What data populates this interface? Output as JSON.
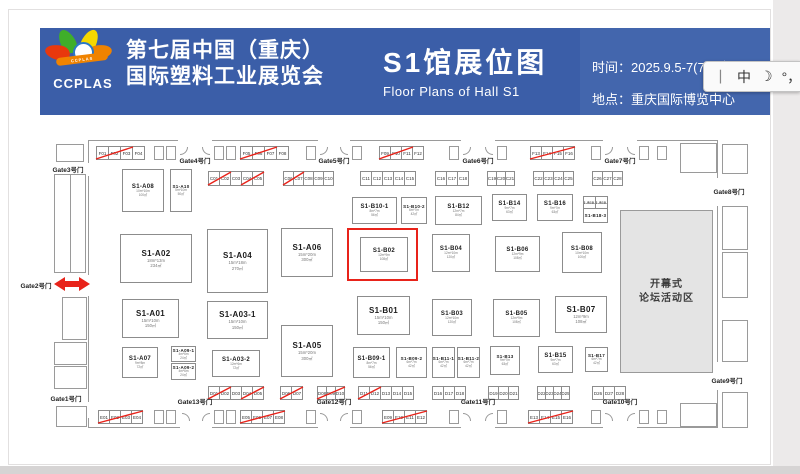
{
  "header": {
    "logo_text": "CCPLAS",
    "logo_ribbon_text": "CCPLAS",
    "title_cn_line1": "第七届中国（重庆）",
    "title_cn_line2": "国际塑料工业展览会",
    "hall_title_cn": "S1馆展位图",
    "hall_title_en": "Floor Plans of Hall S1",
    "time_label": "时间：",
    "time_value": "2025.9.5-7(7.11拟)",
    "venue_label": "地点：",
    "venue_value": "重庆国际博览中心",
    "bg_color": "#3b5ea8"
  },
  "ime_bar": {
    "items": [
      "丨",
      "中",
      "☽",
      "°，",
      "8"
    ]
  },
  "floorplan": {
    "wall_color": "#9a9a9a",
    "accent_red": "#e8231a",
    "hall": {
      "x": 88,
      "y": 140,
      "w": 630,
      "h": 288
    },
    "forum_area": {
      "line1": "开幕式",
      "line2": "论坛活动区",
      "x": 620,
      "y": 210,
      "w": 93,
      "h": 163
    },
    "highlight_box": {
      "x": 347,
      "y": 228,
      "w": 71,
      "h": 53
    },
    "booths": [
      {
        "id": "S1-A08",
        "dims": "10m*10m",
        "area": "100㎡",
        "x": 122,
        "y": 169,
        "w": 42,
        "h": 43
      },
      {
        "id": "S1-A10",
        "dims": "5m*10m",
        "area": "50㎡",
        "x": 170,
        "y": 169,
        "w": 22,
        "h": 43
      },
      {
        "id": "S1-B10-1",
        "dims": "8m*7m",
        "area": "56㎡",
        "x": 352,
        "y": 197,
        "w": 45,
        "h": 27
      },
      {
        "id": "S1-B10-2",
        "dims": "6m*7m",
        "area": "42㎡",
        "x": 401,
        "y": 197,
        "w": 26,
        "h": 27
      },
      {
        "id": "S1-B12",
        "dims": "12m*7m",
        "area": "84㎡",
        "x": 435,
        "y": 196,
        "w": 47,
        "h": 29
      },
      {
        "id": "S1-B14",
        "dims": "9m*7m",
        "area": "63㎡",
        "x": 492,
        "y": 194,
        "w": 35,
        "h": 27
      },
      {
        "id": "S1-B16",
        "dims": "9m*7m",
        "area": "63㎡",
        "x": 537,
        "y": 194,
        "w": 36,
        "h": 27
      },
      {
        "id": "S1-B18-1",
        "dims": "",
        "area": "",
        "x": 583,
        "y": 196,
        "w": 13,
        "h": 13
      },
      {
        "id": "S1-B18-2",
        "dims": "",
        "area": "",
        "x": 595,
        "y": 196,
        "w": 13,
        "h": 13
      },
      {
        "id": "S1-B18-3",
        "dims": "",
        "area": "",
        "x": 583,
        "y": 208,
        "w": 25,
        "h": 15
      },
      {
        "id": "S1-A02",
        "dims": "18m*13m",
        "area": "234㎡",
        "x": 120,
        "y": 234,
        "w": 72,
        "h": 49
      },
      {
        "id": "S1-A04",
        "dims": "15m*18m",
        "area": "270㎡",
        "x": 207,
        "y": 229,
        "w": 61,
        "h": 64
      },
      {
        "id": "S1-A06",
        "dims": "15m*20m",
        "area": "300㎡",
        "x": 281,
        "y": 228,
        "w": 52,
        "h": 49
      },
      {
        "id": "S1-B02",
        "dims": "12m*9m",
        "area": "108㎡",
        "x": 360,
        "y": 237,
        "w": 48,
        "h": 35,
        "highlighted": true
      },
      {
        "id": "S1-B04",
        "dims": "12m*10m",
        "area": "120㎡",
        "x": 432,
        "y": 234,
        "w": 38,
        "h": 38
      },
      {
        "id": "S1-B06",
        "dims": "12m*9m",
        "area": "108㎡",
        "x": 495,
        "y": 236,
        "w": 45,
        "h": 36
      },
      {
        "id": "S1-B08",
        "dims": "10m*10m",
        "area": "100㎡",
        "x": 562,
        "y": 232,
        "w": 40,
        "h": 41
      },
      {
        "id": "S1-A01",
        "dims": "15m*10m",
        "area": "150㎡",
        "x": 122,
        "y": 299,
        "w": 57,
        "h": 39
      },
      {
        "id": "S1-A03-1",
        "dims": "15m*10m",
        "area": "150㎡",
        "x": 207,
        "y": 301,
        "w": 61,
        "h": 38
      },
      {
        "id": "S1-B01",
        "dims": "15m*10m",
        "area": "150㎡",
        "x": 357,
        "y": 296,
        "w": 53,
        "h": 39
      },
      {
        "id": "S1-B03",
        "dims": "12m*10m",
        "area": "120㎡",
        "x": 432,
        "y": 299,
        "w": 40,
        "h": 37
      },
      {
        "id": "S1-B05",
        "dims": "12m*9m",
        "area": "108㎡",
        "x": 493,
        "y": 299,
        "w": 47,
        "h": 38
      },
      {
        "id": "S1-B07",
        "dims": "12m*9m",
        "area": "108㎡",
        "x": 555,
        "y": 296,
        "w": 52,
        "h": 37
      },
      {
        "id": "S1-A07",
        "dims": "9m*8m",
        "area": "72㎡",
        "x": 122,
        "y": 347,
        "w": 36,
        "h": 31
      },
      {
        "id": "S1-A09-1",
        "dims": "4m*6m",
        "area": "24㎡",
        "x": 171,
        "y": 346,
        "w": 25,
        "h": 16
      },
      {
        "id": "S1-A09-2",
        "dims": "4m*6m",
        "area": "24㎡",
        "x": 171,
        "y": 363,
        "w": 25,
        "h": 17
      },
      {
        "id": "S1-A03-2",
        "dims": "12m*6m",
        "area": "72㎡",
        "x": 212,
        "y": 350,
        "w": 48,
        "h": 27
      },
      {
        "id": "S1-A05",
        "dims": "15m*20m",
        "area": "300㎡",
        "x": 281,
        "y": 325,
        "w": 52,
        "h": 52
      },
      {
        "id": "S1-B09-1",
        "dims": "8m*7m",
        "area": "56㎡",
        "x": 353,
        "y": 347,
        "w": 37,
        "h": 31
      },
      {
        "id": "S1-B09-2",
        "dims": "6m*7m",
        "area": "42㎡",
        "x": 396,
        "y": 347,
        "w": 31,
        "h": 31
      },
      {
        "id": "S1-B11-1",
        "dims": "6m*7m",
        "area": "42㎡",
        "x": 432,
        "y": 347,
        "w": 23,
        "h": 31
      },
      {
        "id": "S1-B11-2",
        "dims": "6m*7m",
        "area": "42㎡",
        "x": 457,
        "y": 347,
        "w": 23,
        "h": 31
      },
      {
        "id": "S1-B13",
        "dims": "9m*7m",
        "area": "63㎡",
        "x": 490,
        "y": 346,
        "w": 30,
        "h": 29
      },
      {
        "id": "S1-B15",
        "dims": "9m*7m",
        "area": "63㎡",
        "x": 538,
        "y": 346,
        "w": 35,
        "h": 27
      },
      {
        "id": "S1-B17",
        "dims": "6m*7m",
        "area": "42㎡",
        "x": 585,
        "y": 347,
        "w": 23,
        "h": 25
      }
    ],
    "cell_groups": [
      {
        "cells": [
          "F01",
          "F02",
          "F03",
          "F04"
        ],
        "x": 96,
        "y": 146,
        "cw": 13,
        "ch": 14,
        "strikes": [
          [
            0,
            2
          ]
        ]
      },
      {
        "cells": [
          "F05",
          "F06",
          "F07",
          "F08"
        ],
        "x": 240,
        "y": 146,
        "cw": 13,
        "ch": 14,
        "strikes": [
          [
            0,
            2
          ]
        ]
      },
      {
        "cells": [
          "F09",
          "F10",
          "F11",
          "F12"
        ],
        "x": 379,
        "y": 146,
        "cw": 12,
        "ch": 14,
        "strikes": [
          [
            0,
            2
          ]
        ]
      },
      {
        "cells": [
          "F13",
          "F14",
          "F15",
          "F16"
        ],
        "x": 530,
        "y": 146,
        "cw": 12,
        "ch": 14,
        "strikes": [
          [
            0,
            3
          ]
        ]
      },
      {
        "cells": [
          "C01",
          "C02",
          "C03",
          "C04",
          "C05"
        ],
        "x": 208,
        "y": 171,
        "cw": 12,
        "ch": 15,
        "strikes": [
          [
            0,
            1
          ],
          [
            3,
            4
          ]
        ]
      },
      {
        "cells": [
          "C06",
          "C07",
          "C08",
          "C09",
          "C10"
        ],
        "x": 283,
        "y": 171,
        "cw": 11,
        "ch": 15,
        "strikes": [
          [
            0,
            1
          ]
        ]
      },
      {
        "cells": [
          "C11",
          "C12",
          "C13",
          "C14",
          "C15"
        ],
        "x": 360,
        "y": 171,
        "cw": 12,
        "ch": 15,
        "strikes": []
      },
      {
        "cells": [
          "C16",
          "C17",
          "C18"
        ],
        "x": 435,
        "y": 171,
        "cw": 12,
        "ch": 15,
        "strikes": []
      },
      {
        "cells": [
          "C19",
          "C20",
          "C21"
        ],
        "x": 487,
        "y": 171,
        "cw": 10,
        "ch": 15,
        "strikes": []
      },
      {
        "cells": [
          "C22",
          "C23",
          "C24",
          "C25"
        ],
        "x": 533,
        "y": 171,
        "cw": 11,
        "ch": 15,
        "strikes": []
      },
      {
        "cells": [
          "C26",
          "C27",
          "C28"
        ],
        "x": 592,
        "y": 171,
        "cw": 11,
        "ch": 15,
        "strikes": []
      },
      {
        "cells": [
          "D01",
          "D02",
          "D03",
          "D04",
          "D05"
        ],
        "x": 208,
        "y": 386,
        "cw": 12,
        "ch": 14,
        "strikes": [
          [
            0,
            1
          ],
          [
            3,
            4
          ]
        ]
      },
      {
        "cells": [
          "D06",
          "D07"
        ],
        "x": 280,
        "y": 386,
        "cw": 12,
        "ch": 14,
        "strikes": [
          [
            0,
            1
          ]
        ]
      },
      {
        "cells": [
          "D08",
          "D09",
          "D10"
        ],
        "x": 317,
        "y": 386,
        "cw": 10,
        "ch": 14,
        "strikes": [
          [
            0,
            2
          ]
        ]
      },
      {
        "cells": [
          "D11",
          "D12",
          "D13",
          "D14",
          "D15"
        ],
        "x": 358,
        "y": 386,
        "cw": 12,
        "ch": 14,
        "strikes": [
          [
            0,
            1
          ]
        ]
      },
      {
        "cells": [
          "D16",
          "D17",
          "D18"
        ],
        "x": 432,
        "y": 386,
        "cw": 12,
        "ch": 14,
        "strikes": []
      },
      {
        "cells": [
          "D19",
          "D20",
          "D21"
        ],
        "x": 488,
        "y": 386,
        "cw": 11,
        "ch": 14,
        "strikes": []
      },
      {
        "cells": [
          "D22",
          "D23",
          "D24",
          "D25"
        ],
        "x": 537,
        "y": 386,
        "cw": 9,
        "ch": 14,
        "strikes": []
      },
      {
        "cells": [
          "D26",
          "D27",
          "D28"
        ],
        "x": 592,
        "y": 386,
        "cw": 12,
        "ch": 14,
        "strikes": []
      },
      {
        "cells": [
          "E01",
          "E02",
          "E03",
          "E04"
        ],
        "x": 98,
        "y": 410,
        "cw": 12,
        "ch": 14,
        "strikes": [
          [
            0,
            3
          ]
        ]
      },
      {
        "cells": [
          "E05",
          "E06",
          "E07",
          "E08"
        ],
        "x": 240,
        "y": 410,
        "cw": 12,
        "ch": 14,
        "strikes": [
          [
            0,
            3
          ]
        ]
      },
      {
        "cells": [
          "E09",
          "E10",
          "E11",
          "E12"
        ],
        "x": 382,
        "y": 410,
        "cw": 12,
        "ch": 14,
        "strikes": [
          [
            0,
            3
          ]
        ]
      },
      {
        "cells": [
          "E13",
          "E14",
          "E15",
          "E16"
        ],
        "x": 528,
        "y": 410,
        "cw": 12,
        "ch": 14,
        "strikes": [
          [
            0,
            3
          ]
        ]
      }
    ],
    "gates": [
      {
        "label": "Gate3号门",
        "x": 68,
        "y": 164
      },
      {
        "label": "Gate4号门",
        "x": 195,
        "y": 155
      },
      {
        "label": "Gate5号门",
        "x": 334,
        "y": 155
      },
      {
        "label": "Gate6号门",
        "x": 478,
        "y": 155
      },
      {
        "label": "Gate7号门",
        "x": 620,
        "y": 155
      },
      {
        "label": "Gate8号门",
        "x": 729,
        "y": 186
      },
      {
        "label": "Gate9号门",
        "x": 727,
        "y": 375
      },
      {
        "label": "Gate10号门",
        "x": 620,
        "y": 396
      },
      {
        "label": "Gate11号门",
        "x": 478,
        "y": 396
      },
      {
        "label": "Gate12号门",
        "x": 334,
        "y": 396
      },
      {
        "label": "Gate13号门",
        "x": 195,
        "y": 396
      },
      {
        "label": "Gate1号门",
        "x": 66,
        "y": 393
      },
      {
        "label": "Gate2号门",
        "x": 36,
        "y": 280
      }
    ],
    "rooms": [
      {
        "x": 56,
        "y": 144,
        "w": 28,
        "h": 18
      },
      {
        "x": 54,
        "y": 174,
        "w": 17,
        "h": 99
      },
      {
        "x": 70,
        "y": 174,
        "w": 16,
        "h": 99
      },
      {
        "x": 62,
        "y": 297,
        "w": 25,
        "h": 43
      },
      {
        "x": 54,
        "y": 342,
        "w": 33,
        "h": 23
      },
      {
        "x": 54,
        "y": 366,
        "w": 33,
        "h": 23
      },
      {
        "x": 56,
        "y": 406,
        "w": 31,
        "h": 21
      },
      {
        "x": 680,
        "y": 143,
        "w": 37,
        "h": 30
      },
      {
        "x": 722,
        "y": 144,
        "w": 26,
        "h": 30
      },
      {
        "x": 722,
        "y": 206,
        "w": 26,
        "h": 44
      },
      {
        "x": 722,
        "y": 252,
        "w": 26,
        "h": 46
      },
      {
        "x": 722,
        "y": 320,
        "w": 26,
        "h": 42
      },
      {
        "x": 722,
        "y": 392,
        "w": 26,
        "h": 36
      },
      {
        "x": 680,
        "y": 403,
        "w": 37,
        "h": 24
      }
    ],
    "door_cells": {
      "w": 10,
      "h": 14,
      "top_y": 146,
      "top_x": [
        154,
        166,
        214,
        226,
        306,
        352,
        449,
        497,
        591,
        639,
        657
      ],
      "bottom_y": 410,
      "bottom_x": [
        154,
        166,
        214,
        226,
        306,
        352,
        449,
        497,
        591,
        639,
        657
      ]
    },
    "gaps": {
      "top": [
        [
          178,
          34
        ],
        [
          318,
          32
        ],
        [
          461,
          34
        ],
        [
          603,
          34
        ]
      ],
      "bottom": [
        [
          180,
          32
        ],
        [
          318,
          32
        ],
        [
          461,
          34
        ],
        [
          603,
          34
        ]
      ],
      "left": [
        [
          163,
          13
        ],
        [
          275,
          21
        ],
        [
          402,
          16
        ]
      ],
      "right": [
        [
          178,
          28
        ],
        [
          362,
          28
        ]
      ]
    }
  }
}
